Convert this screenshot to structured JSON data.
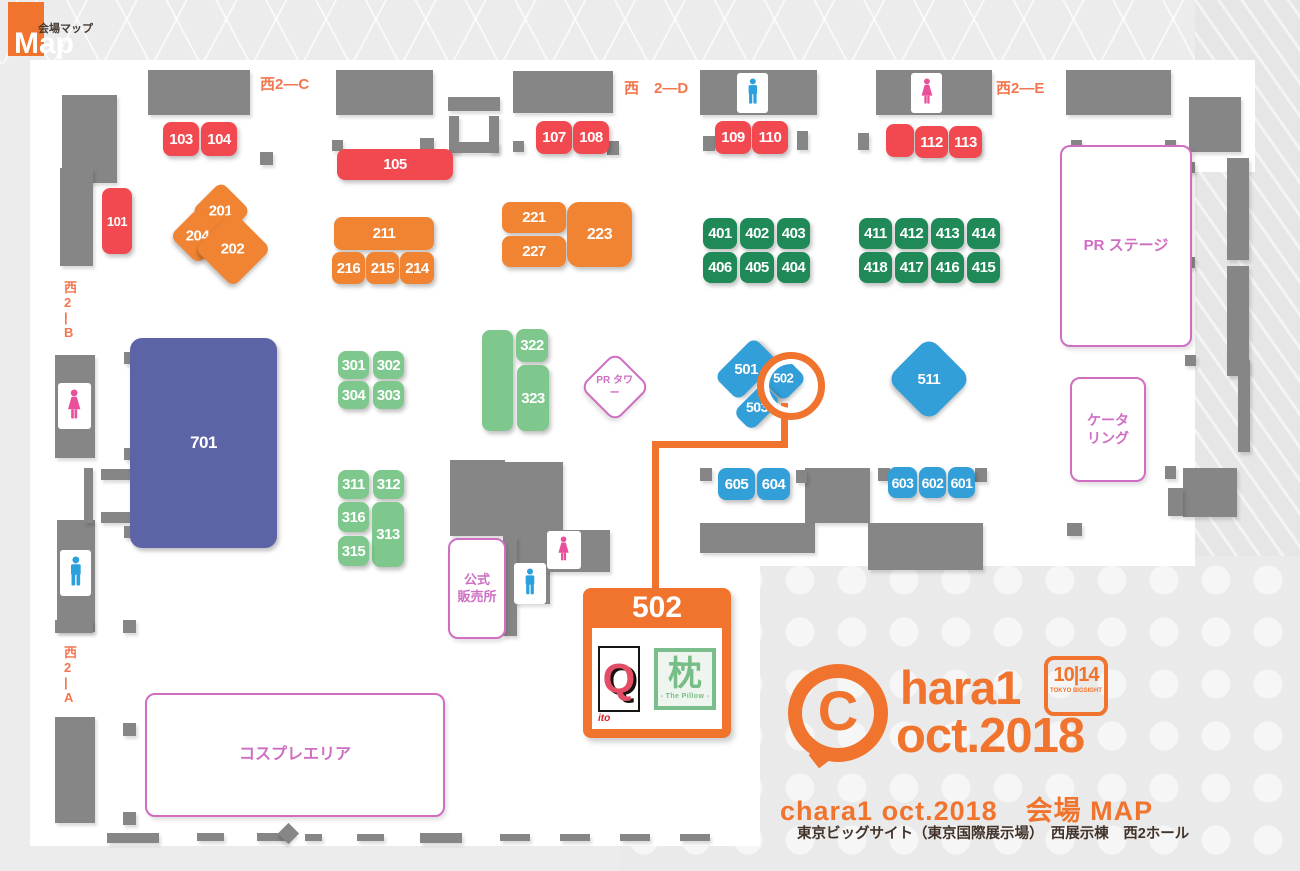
{
  "maplogo": {
    "jp": "会場マップ",
    "en": "Map"
  },
  "map": {
    "wall_color": "#868686",
    "accent_orange": "#f0742e",
    "wall_labels": [
      {
        "t": "西2—C",
        "x": 260,
        "y": 76
      },
      {
        "t": "西　2—D",
        "x": 624,
        "y": 80
      },
      {
        "t": "西2—E",
        "x": 996,
        "y": 80
      },
      {
        "t": "西\n2\n|\nB",
        "x": 64,
        "y": 280,
        "c": "vertical"
      },
      {
        "t": "西\n2\n|\nA",
        "x": 64,
        "y": 645,
        "c": "vertical"
      }
    ],
    "walls": [
      {
        "x": 148,
        "y": 70,
        "w": 102,
        "h": 45
      },
      {
        "x": 336,
        "y": 70,
        "w": 97,
        "h": 45
      },
      {
        "x": 513,
        "y": 71,
        "w": 100,
        "h": 42
      },
      {
        "x": 700,
        "y": 70,
        "w": 117,
        "h": 45
      },
      {
        "x": 876,
        "y": 70,
        "w": 116,
        "h": 45
      },
      {
        "x": 1066,
        "y": 70,
        "w": 105,
        "h": 45
      },
      {
        "x": 1189,
        "y": 97,
        "w": 52,
        "h": 55
      },
      {
        "x": 62,
        "y": 95,
        "w": 55,
        "h": 88
      },
      {
        "x": 60,
        "y": 168,
        "w": 33,
        "h": 98
      },
      {
        "x": 55,
        "y": 355,
        "w": 40,
        "h": 103
      },
      {
        "x": 57,
        "y": 520,
        "w": 38,
        "h": 112
      },
      {
        "x": 55,
        "y": 717,
        "w": 40,
        "h": 106
      },
      {
        "x": 55,
        "y": 620,
        "w": 38,
        "h": 13
      },
      {
        "x": 448,
        "y": 97,
        "w": 52,
        "h": 14
      },
      {
        "x": 449,
        "y": 116,
        "w": 10,
        "h": 37
      },
      {
        "x": 489,
        "y": 116,
        "w": 10,
        "h": 37
      },
      {
        "x": 449,
        "y": 142,
        "w": 50,
        "h": 11
      },
      {
        "x": 84,
        "y": 468,
        "w": 9,
        "h": 55
      },
      {
        "x": 101,
        "y": 469,
        "w": 30,
        "h": 11
      },
      {
        "x": 101,
        "y": 512,
        "w": 30,
        "h": 11
      },
      {
        "x": 124,
        "y": 352,
        "w": 12,
        "h": 12
      },
      {
        "x": 124,
        "y": 448,
        "w": 12,
        "h": 12
      },
      {
        "x": 124,
        "y": 526,
        "w": 12,
        "h": 12
      },
      {
        "x": 193,
        "y": 220,
        "w": 13,
        "h": 13
      },
      {
        "x": 193,
        "y": 503,
        "w": 13,
        "h": 13
      },
      {
        "x": 260,
        "y": 152,
        "w": 13,
        "h": 13
      },
      {
        "x": 332,
        "y": 140,
        "w": 11,
        "h": 11
      },
      {
        "x": 420,
        "y": 138,
        "w": 14,
        "h": 14
      },
      {
        "x": 513,
        "y": 141,
        "w": 11,
        "h": 11
      },
      {
        "x": 607,
        "y": 141,
        "w": 12,
        "h": 14
      },
      {
        "x": 703,
        "y": 136,
        "w": 12,
        "h": 15
      },
      {
        "x": 797,
        "y": 131,
        "w": 11,
        "h": 19
      },
      {
        "x": 858,
        "y": 133,
        "w": 11,
        "h": 17
      },
      {
        "x": 975,
        "y": 139,
        "w": 5,
        "h": 15
      },
      {
        "x": 1071,
        "y": 140,
        "w": 11,
        "h": 11
      },
      {
        "x": 1165,
        "y": 140,
        "w": 11,
        "h": 11
      },
      {
        "x": 1183,
        "y": 162,
        "w": 12,
        "h": 11
      },
      {
        "x": 1183,
        "y": 257,
        "w": 12,
        "h": 11
      },
      {
        "x": 1185,
        "y": 355,
        "w": 11,
        "h": 11
      },
      {
        "x": 1165,
        "y": 466,
        "w": 11,
        "h": 13
      },
      {
        "x": 1227,
        "y": 158,
        "w": 22,
        "h": 102
      },
      {
        "x": 1227,
        "y": 266,
        "w": 22,
        "h": 110
      },
      {
        "x": 1238,
        "y": 360,
        "w": 12,
        "h": 92
      },
      {
        "x": 1183,
        "y": 468,
        "w": 54,
        "h": 49
      },
      {
        "x": 1168,
        "y": 488,
        "w": 15,
        "h": 28
      },
      {
        "x": 1067,
        "y": 523,
        "w": 15,
        "h": 13
      },
      {
        "x": 805,
        "y": 468,
        "w": 65,
        "h": 55
      },
      {
        "x": 700,
        "y": 523,
        "w": 100,
        "h": 30
      },
      {
        "x": 800,
        "y": 523,
        "w": 15,
        "h": 30
      },
      {
        "x": 868,
        "y": 523,
        "w": 115,
        "h": 47
      },
      {
        "x": 700,
        "y": 468,
        "w": 12,
        "h": 13
      },
      {
        "x": 796,
        "y": 470,
        "w": 11,
        "h": 13
      },
      {
        "x": 878,
        "y": 468,
        "w": 12,
        "h": 13
      },
      {
        "x": 975,
        "y": 468,
        "w": 12,
        "h": 14
      },
      {
        "x": 450,
        "y": 460,
        "w": 55,
        "h": 76
      },
      {
        "x": 503,
        "y": 462,
        "w": 60,
        "h": 75
      },
      {
        "x": 515,
        "y": 537,
        "w": 35,
        "h": 67
      },
      {
        "x": 547,
        "y": 530,
        "w": 63,
        "h": 42
      },
      {
        "x": 503,
        "y": 537,
        "w": 14,
        "h": 99
      },
      {
        "x": 123,
        "y": 620,
        "w": 13,
        "h": 13
      },
      {
        "x": 123,
        "y": 723,
        "w": 13,
        "h": 13
      },
      {
        "x": 123,
        "y": 812,
        "w": 13,
        "h": 13
      },
      {
        "x": 107,
        "y": 833,
        "w": 52,
        "h": 10
      },
      {
        "x": 197,
        "y": 833,
        "w": 27,
        "h": 8
      },
      {
        "x": 257,
        "y": 833,
        "w": 30,
        "h": 8
      },
      {
        "x": 305,
        "y": 834,
        "w": 17,
        "h": 7
      },
      {
        "x": 357,
        "y": 834,
        "w": 27,
        "h": 7
      },
      {
        "x": 420,
        "y": 833,
        "w": 42,
        "h": 10
      },
      {
        "x": 500,
        "y": 834,
        "w": 30,
        "h": 7
      },
      {
        "x": 560,
        "y": 834,
        "w": 30,
        "h": 7
      },
      {
        "x": 620,
        "y": 834,
        "w": 30,
        "h": 7
      },
      {
        "x": 680,
        "y": 834,
        "w": 30,
        "h": 7
      },
      {
        "x": 281,
        "y": 826,
        "w": 15,
        "h": 15,
        "r": 45
      }
    ],
    "booths": [
      {
        "t": "101",
        "x": 102,
        "y": 188,
        "w": 30,
        "h": 66,
        "c": "red",
        "fs": 13
      },
      {
        "t": "103",
        "x": 163,
        "y": 122,
        "w": 36,
        "h": 34,
        "c": "red"
      },
      {
        "t": "104",
        "x": 201,
        "y": 122,
        "w": 36,
        "h": 34,
        "c": "red"
      },
      {
        "t": "105",
        "x": 337,
        "y": 149,
        "w": 116,
        "h": 31,
        "c": "red"
      },
      {
        "t": "107",
        "x": 536,
        "y": 121,
        "w": 36,
        "h": 33,
        "c": "red"
      },
      {
        "t": "108",
        "x": 573,
        "y": 121,
        "w": 36,
        "h": 33,
        "c": "red"
      },
      {
        "t": "109",
        "x": 715,
        "y": 121,
        "w": 36,
        "h": 33,
        "c": "red"
      },
      {
        "t": "110",
        "x": 752,
        "y": 121,
        "w": 36,
        "h": 33,
        "c": "red"
      },
      {
        "t": "",
        "x": 886,
        "y": 124,
        "w": 28,
        "h": 33,
        "c": "red"
      },
      {
        "t": "112",
        "x": 915,
        "y": 126,
        "w": 33,
        "h": 32,
        "c": "red"
      },
      {
        "t": "113",
        "x": 949,
        "y": 126,
        "w": 33,
        "h": 32,
        "c": "red"
      },
      {
        "t": "201",
        "x": 200,
        "y": 190,
        "w": 42,
        "h": 42,
        "c": "orange",
        "r": 45
      },
      {
        "t": "204",
        "x": 178,
        "y": 216,
        "w": 40,
        "h": 40,
        "c": "orange",
        "r": 45
      },
      {
        "t": "202",
        "x": 206,
        "y": 222,
        "w": 54,
        "h": 54,
        "c": "orange",
        "r": 45
      },
      {
        "t": "211",
        "x": 334,
        "y": 217,
        "w": 100,
        "h": 33,
        "c": "orange"
      },
      {
        "t": "216",
        "x": 332,
        "y": 252,
        "w": 33,
        "h": 32,
        "c": "orange"
      },
      {
        "t": "215",
        "x": 366,
        "y": 252,
        "w": 33,
        "h": 32,
        "c": "orange"
      },
      {
        "t": "214",
        "x": 400,
        "y": 252,
        "w": 34,
        "h": 32,
        "c": "orange"
      },
      {
        "t": "221",
        "x": 502,
        "y": 202,
        "w": 64,
        "h": 31,
        "c": "orange"
      },
      {
        "t": "227",
        "x": 502,
        "y": 236,
        "w": 64,
        "h": 31,
        "c": "orange"
      },
      {
        "t": "223",
        "x": 567,
        "y": 202,
        "w": 65,
        "h": 65,
        "c": "orange big",
        "fs": 16
      },
      {
        "t": "401",
        "x": 703,
        "y": 218,
        "w": 34,
        "h": 31,
        "c": "green-dark"
      },
      {
        "t": "402",
        "x": 740,
        "y": 218,
        "w": 34,
        "h": 31,
        "c": "green-dark"
      },
      {
        "t": "403",
        "x": 777,
        "y": 218,
        "w": 33,
        "h": 31,
        "c": "green-dark"
      },
      {
        "t": "406",
        "x": 703,
        "y": 252,
        "w": 34,
        "h": 31,
        "c": "green-dark"
      },
      {
        "t": "405",
        "x": 740,
        "y": 252,
        "w": 34,
        "h": 31,
        "c": "green-dark"
      },
      {
        "t": "404",
        "x": 777,
        "y": 252,
        "w": 33,
        "h": 31,
        "c": "green-dark"
      },
      {
        "t": "411",
        "x": 859,
        "y": 218,
        "w": 33,
        "h": 31,
        "c": "green-dark"
      },
      {
        "t": "412",
        "x": 895,
        "y": 218,
        "w": 33,
        "h": 31,
        "c": "green-dark"
      },
      {
        "t": "413",
        "x": 931,
        "y": 218,
        "w": 33,
        "h": 31,
        "c": "green-dark"
      },
      {
        "t": "414",
        "x": 967,
        "y": 218,
        "w": 33,
        "h": 31,
        "c": "green-dark"
      },
      {
        "t": "418",
        "x": 859,
        "y": 252,
        "w": 33,
        "h": 31,
        "c": "green-dark"
      },
      {
        "t": "417",
        "x": 895,
        "y": 252,
        "w": 33,
        "h": 31,
        "c": "green-dark"
      },
      {
        "t": "416",
        "x": 931,
        "y": 252,
        "w": 33,
        "h": 31,
        "c": "green-dark"
      },
      {
        "t": "415",
        "x": 967,
        "y": 252,
        "w": 33,
        "h": 31,
        "c": "green-dark"
      },
      {
        "t": "301",
        "x": 338,
        "y": 351,
        "w": 31,
        "h": 28,
        "c": "green-light"
      },
      {
        "t": "302",
        "x": 373,
        "y": 351,
        "w": 31,
        "h": 28,
        "c": "green-light"
      },
      {
        "t": "304",
        "x": 338,
        "y": 381,
        "w": 31,
        "h": 28,
        "c": "green-light"
      },
      {
        "t": "303",
        "x": 373,
        "y": 381,
        "w": 31,
        "h": 28,
        "c": "green-light"
      },
      {
        "t": "",
        "x": 482,
        "y": 330,
        "w": 31,
        "h": 101,
        "c": "green-light"
      },
      {
        "t": "322",
        "x": 516,
        "y": 329,
        "w": 32,
        "h": 33,
        "c": "green-light"
      },
      {
        "t": "323",
        "x": 517,
        "y": 365,
        "w": 32,
        "h": 66,
        "c": "green-light"
      },
      {
        "t": "311",
        "x": 338,
        "y": 470,
        "w": 31,
        "h": 29,
        "c": "green-light"
      },
      {
        "t": "312",
        "x": 373,
        "y": 470,
        "w": 31,
        "h": 29,
        "c": "green-light"
      },
      {
        "t": "316",
        "x": 338,
        "y": 502,
        "w": 31,
        "h": 30,
        "c": "green-light"
      },
      {
        "t": "313",
        "x": 372,
        "y": 502,
        "w": 32,
        "h": 65,
        "c": "green-light"
      },
      {
        "t": "315",
        "x": 338,
        "y": 536,
        "w": 31,
        "h": 30,
        "c": "green-light"
      },
      {
        "t": "501",
        "x": 718,
        "y": 352,
        "w": 56,
        "h": 34,
        "c": "blue",
        "r": -45
      },
      {
        "t": "502",
        "x": 767,
        "y": 362,
        "w": 33,
        "h": 33,
        "c": "blue",
        "fs": 13,
        "r": 45
      },
      {
        "t": "503",
        "x": 736,
        "y": 394,
        "w": 42,
        "h": 26,
        "c": "blue",
        "fs": 14,
        "r": -45
      },
      {
        "t": "511",
        "x": 899,
        "y": 349,
        "w": 60,
        "h": 60,
        "c": "blue big",
        "r": 45
      },
      {
        "t": "605",
        "x": 718,
        "y": 468,
        "w": 37,
        "h": 32,
        "c": "blue"
      },
      {
        "t": "604",
        "x": 757,
        "y": 468,
        "w": 33,
        "h": 32,
        "c": "blue"
      },
      {
        "t": "603",
        "x": 888,
        "y": 467,
        "w": 29,
        "h": 31,
        "c": "blue",
        "fs": 14
      },
      {
        "t": "602",
        "x": 919,
        "y": 467,
        "w": 27,
        "h": 31,
        "c": "blue",
        "fs": 14
      },
      {
        "t": "601",
        "x": 948,
        "y": 467,
        "w": 27,
        "h": 31,
        "c": "blue",
        "fs": 14
      },
      {
        "t": "701",
        "x": 130,
        "y": 338,
        "w": 147,
        "h": 210,
        "c": "purple",
        "fs": 17
      }
    ],
    "areas": [
      {
        "t": "PR ステージ",
        "x": 1060,
        "y": 145,
        "w": 128,
        "h": 198,
        "fs": 15
      },
      {
        "t": "PR タワー",
        "x": 590,
        "y": 362,
        "w": 46,
        "h": 46,
        "r": 45,
        "fs": 10
      },
      {
        "t": "ケータ\nリング",
        "x": 1070,
        "y": 377,
        "w": 72,
        "h": 101,
        "fs": 14
      },
      {
        "t": "公式\n販売所",
        "x": 448,
        "y": 538,
        "w": 54,
        "h": 97,
        "fs": 13
      },
      {
        "t": "コスプレエリア",
        "x": 145,
        "y": 693,
        "w": 296,
        "h": 120,
        "fs": 16
      }
    ],
    "toilets": [
      {
        "type": "men",
        "x": 737,
        "y": 73,
        "w": 31,
        "h": 40
      },
      {
        "type": "women",
        "x": 911,
        "y": 73,
        "w": 31,
        "h": 40
      },
      {
        "type": "women",
        "x": 58,
        "y": 383,
        "w": 33,
        "h": 46
      },
      {
        "type": "men",
        "x": 60,
        "y": 550,
        "w": 31,
        "h": 46
      },
      {
        "type": "women",
        "x": 547,
        "y": 531,
        "w": 34,
        "h": 38
      },
      {
        "type": "men",
        "x": 514,
        "y": 563,
        "w": 32,
        "h": 41
      }
    ]
  },
  "callout": {
    "booth": "502",
    "exhibitors": {
      "q_mark": "Q",
      "q_sub": "ito",
      "pillow_kanji": "枕",
      "pillow_sub": "- The Pillow -"
    }
  },
  "logo": {
    "c": "C",
    "hara": "hara1",
    "oct": "oct.2018",
    "date": "10|14",
    "venue": "TOKYO BIGSIGHT"
  },
  "footer": {
    "title": "chara1 oct.2018　会場 MAP",
    "subtitle": "東京ビッグサイト（東京国際展示場）　西展示棟　西2ホール"
  }
}
